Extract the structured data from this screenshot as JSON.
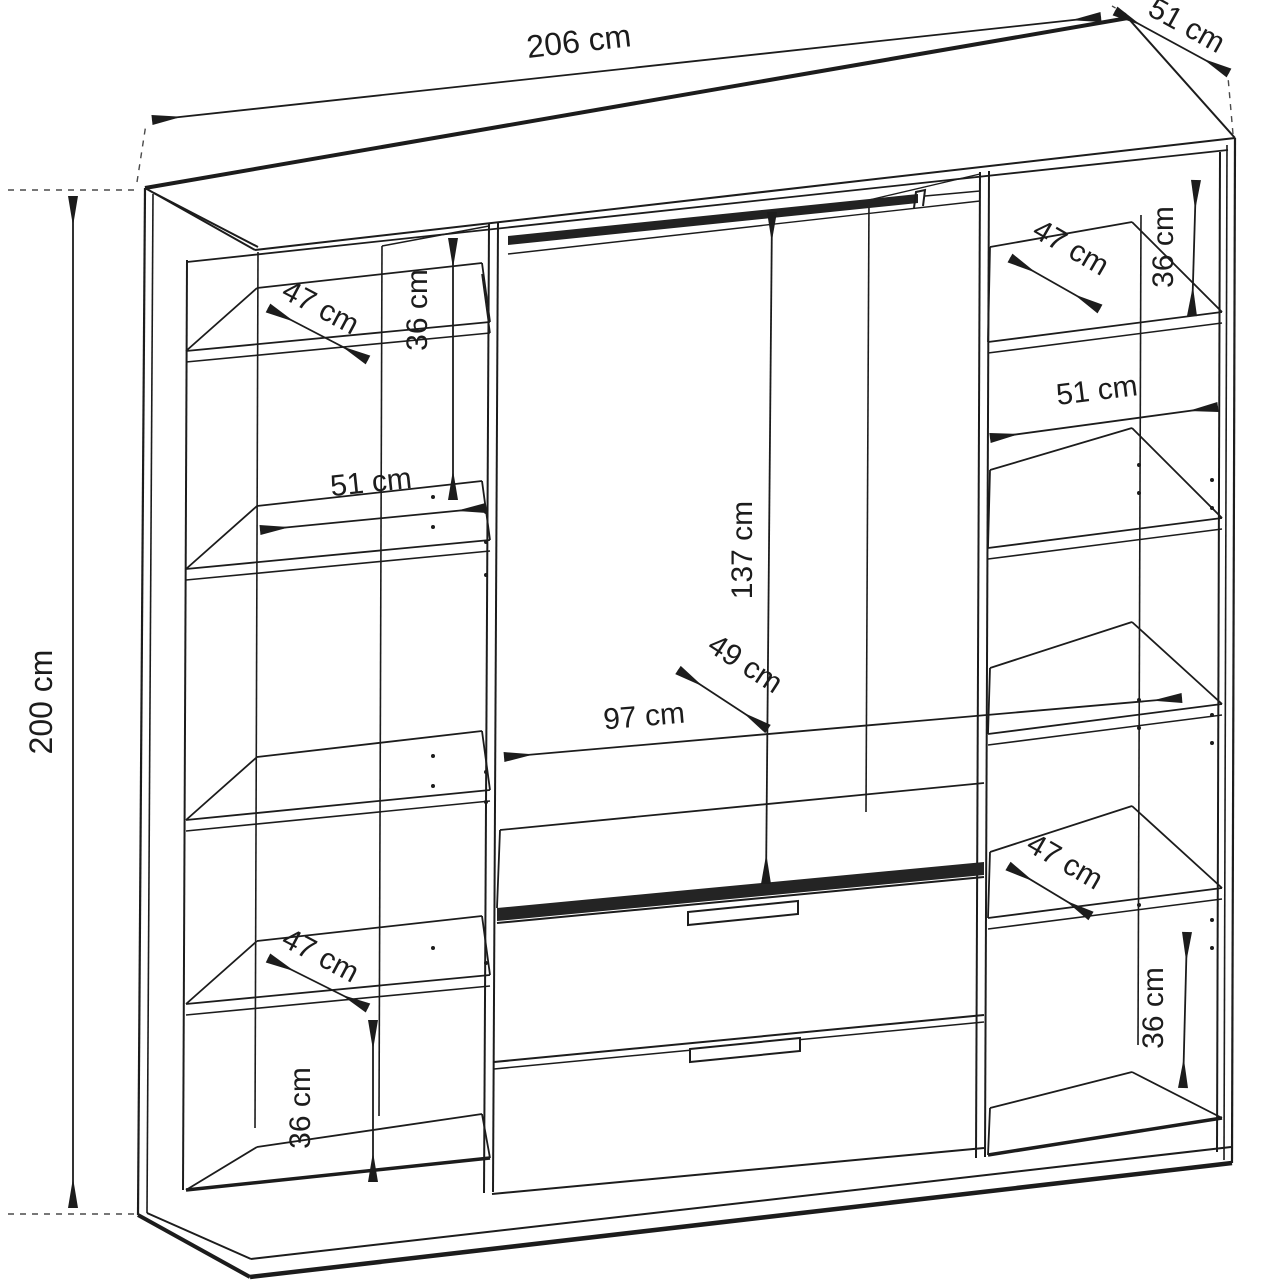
{
  "colors": {
    "line": "#1c1c1c",
    "background": "#ffffff",
    "dashed": "#4a4a4a"
  },
  "dimensions": {
    "overall_width": "206 cm",
    "overall_depth": "51 cm",
    "overall_height": "200 cm",
    "left_column": {
      "top_gap": "36 cm",
      "top_shelf_depth": "47 cm",
      "shelf_width": "51 cm",
      "bottom_shelf_depth": "47 cm",
      "bottom_gap": "36 cm"
    },
    "center": {
      "hanging_height": "137 cm",
      "hanging_depth": "49 cm",
      "width": "97 cm"
    },
    "right_column": {
      "top_gap": "36 cm",
      "top_shelf_depth": "47 cm",
      "shelf_width": "51 cm",
      "bottom_shelf_depth": "47 cm",
      "bottom_gap": "36 cm"
    }
  }
}
